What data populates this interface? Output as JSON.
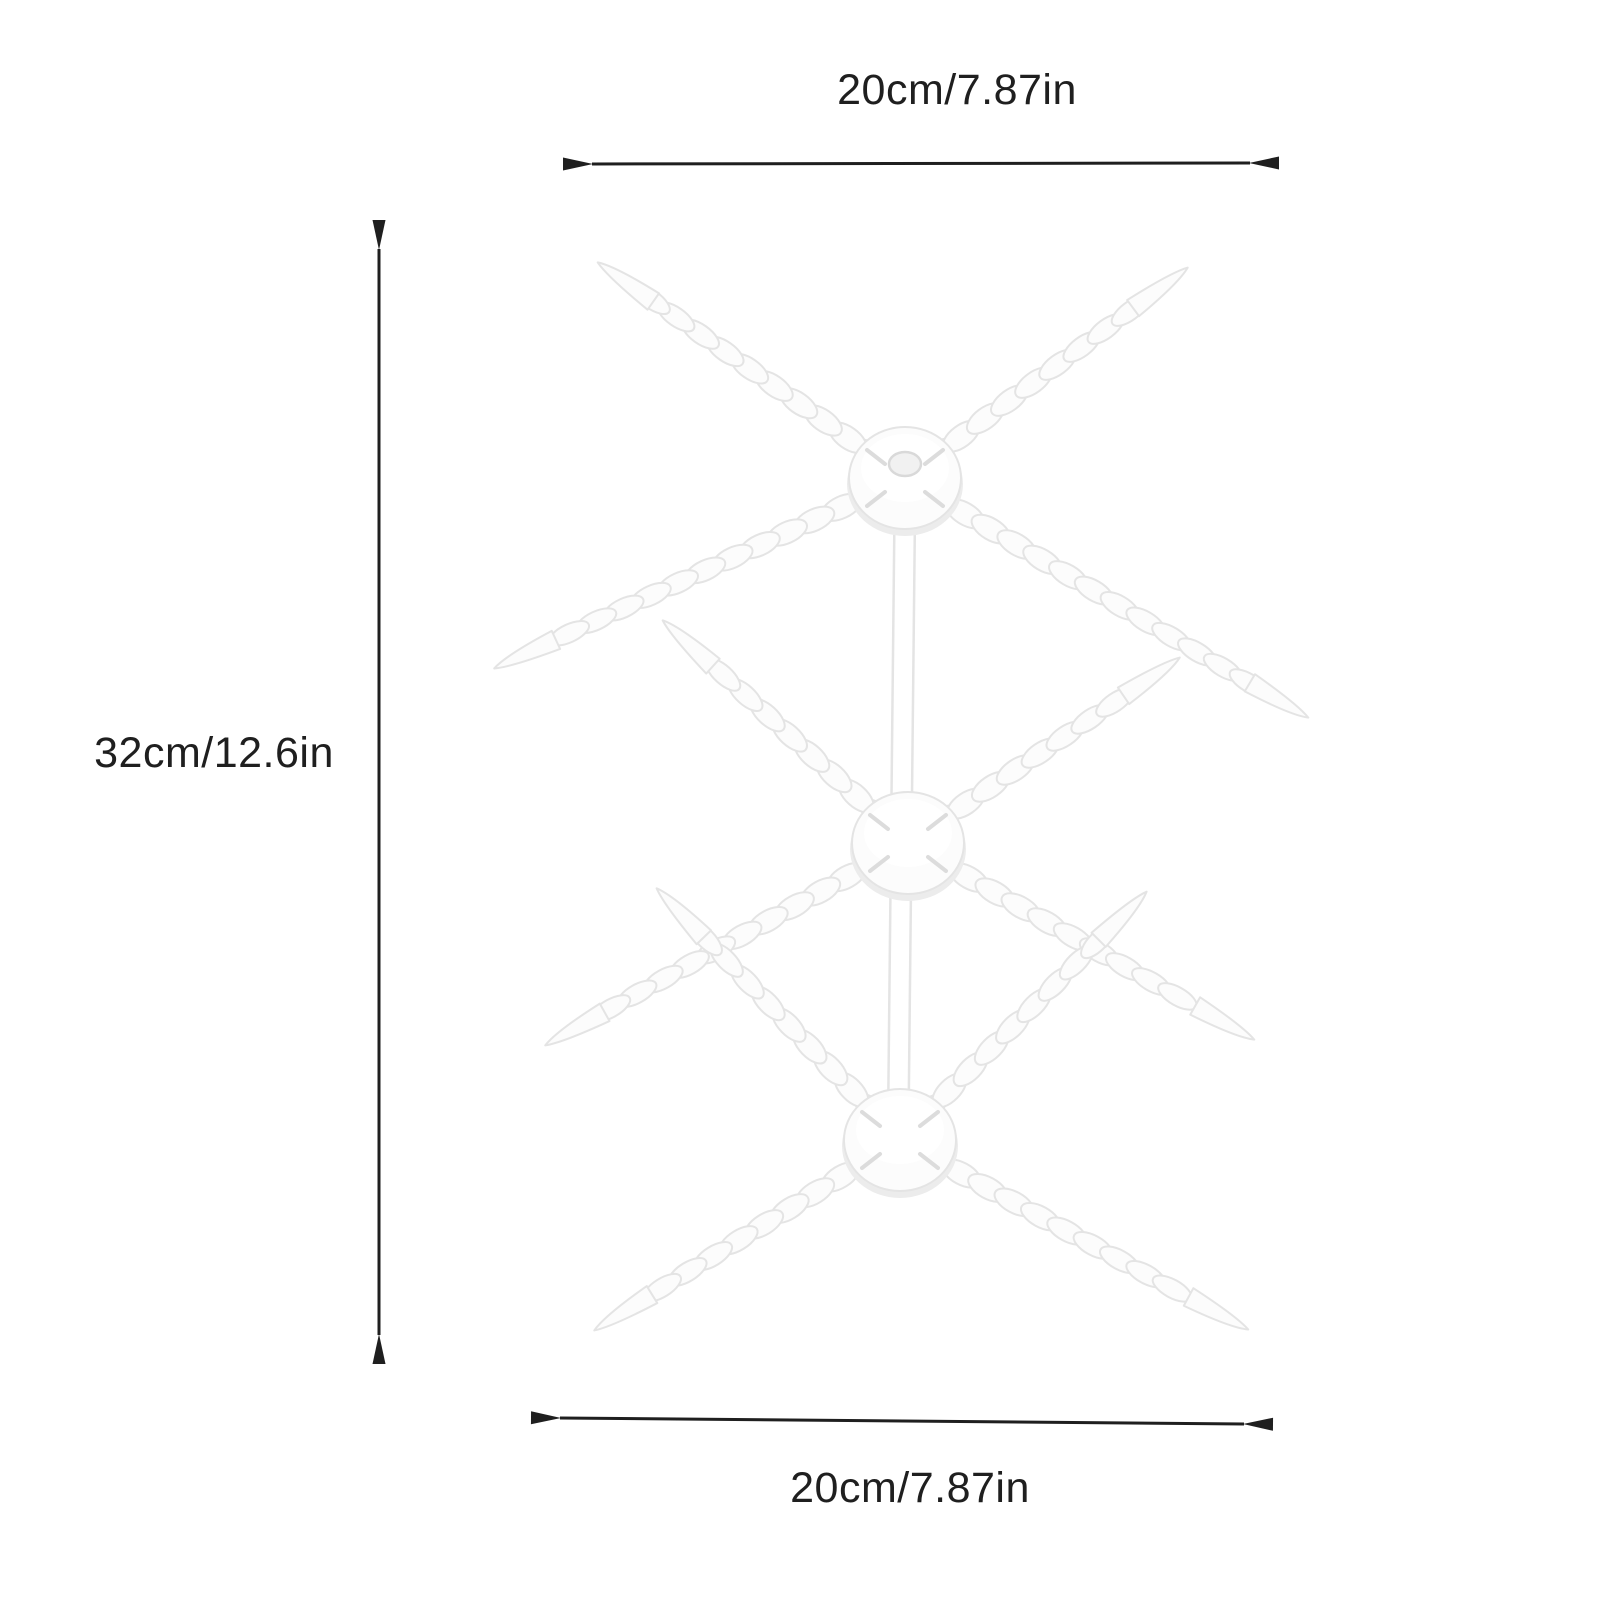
{
  "page": {
    "background": "#ffffff"
  },
  "illustration": {
    "name": "pasta-drying-rack",
    "tiers": 3,
    "fill": "#fcfcfc",
    "outline": "#e4e4e4",
    "shadow": "#ececec",
    "hole_fill": "#f1f1f1",
    "hole_outline": "#d9d9d9"
  },
  "dimensions": {
    "top": {
      "label": "20cm/7.87in"
    },
    "left": {
      "label": "32cm/12.6in"
    },
    "bottom": {
      "label": "20cm/7.87in"
    },
    "line_color": "#1f1f1f",
    "text_color": "#1f1f1f"
  }
}
